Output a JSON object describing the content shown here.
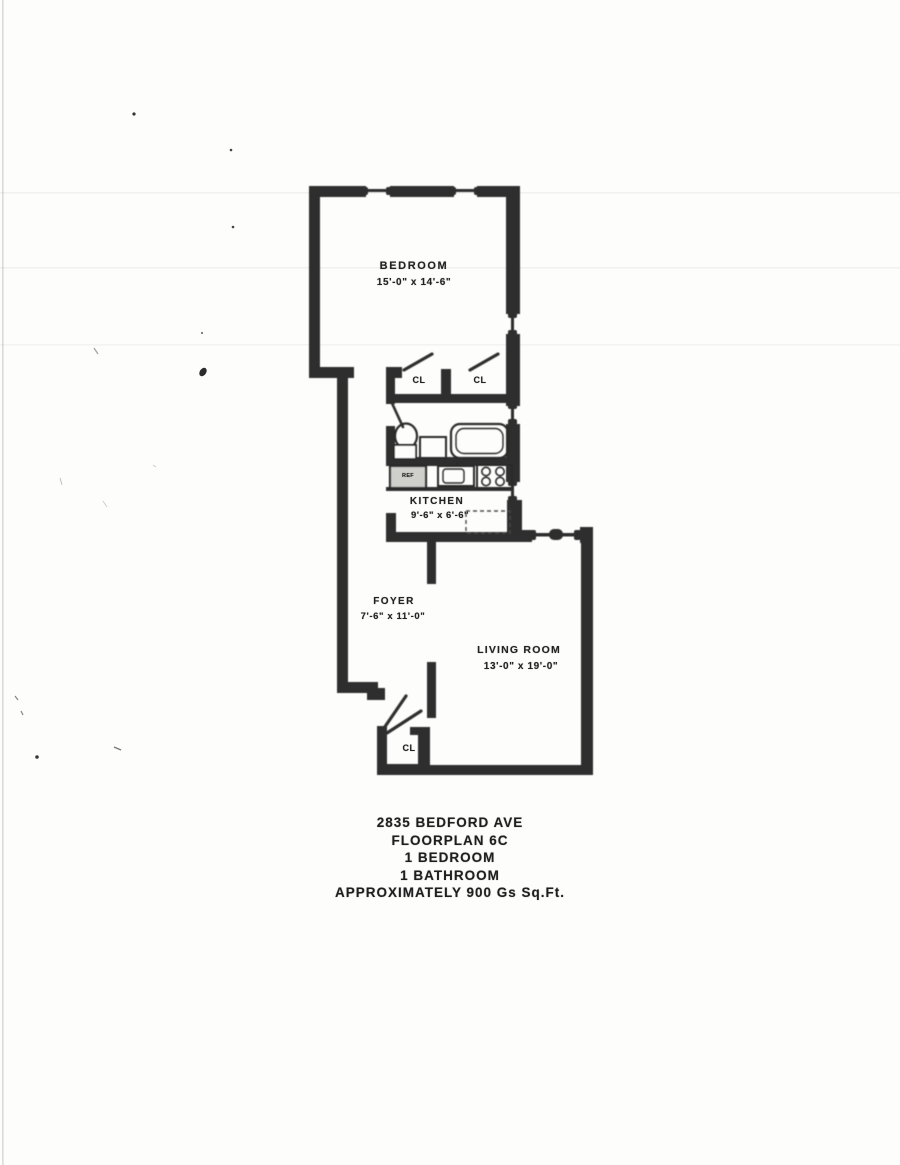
{
  "floorplan": {
    "bedroom": {
      "label": "BEDROOM",
      "dims": "15'-0\" x 14'-6\""
    },
    "kitchen": {
      "label": "KITCHEN",
      "dims": "9'-6\" x 6'-6\""
    },
    "foyer": {
      "label": "FOYER",
      "dims": "7'-6\" x 11'-0\""
    },
    "living_room": {
      "label": "LIVING ROOM",
      "dims": "13'-0\" x 19'-0\""
    },
    "closet_label": "CL",
    "fridge_label": "REF"
  },
  "caption": {
    "address": "2835 BEDFORD AVE",
    "plan_name": "FLOORPLAN 6C",
    "bedrooms": "1 BEDROOM",
    "bathrooms": "1 BATHROOM",
    "area": "APPROXIMATELY 900 Gs Sq.Ft."
  },
  "colors": {
    "wall": "#2d2d2d",
    "ink": "#1f1f1f",
    "paper": "#fdfdfc"
  }
}
